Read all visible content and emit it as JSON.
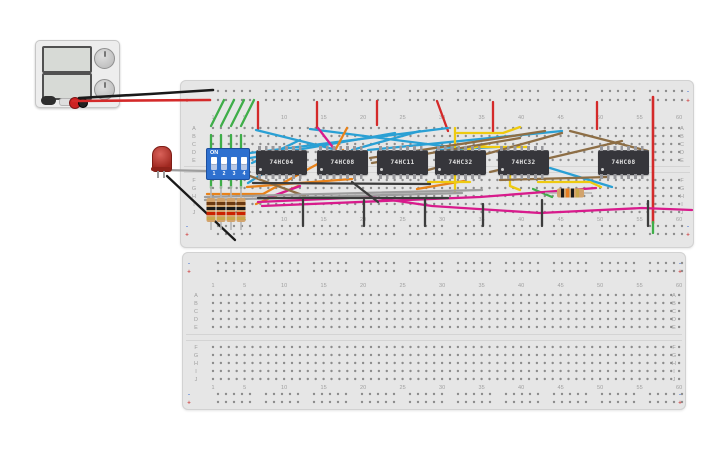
{
  "app": {
    "background": "#ffffff"
  },
  "palette": {
    "cyan": "#2aa0d4",
    "orange": "#e8821a",
    "magenta": "#d81b8c",
    "yellow": "#eeca10",
    "brown": "#8d6e45",
    "gray": "#9e9e9e",
    "ltgray": "#b5b5b5",
    "dark": "#3c3c3c",
    "black": "#1a1a1a",
    "green": "#3fae49",
    "red": "#d42a2a",
    "rail_minus_color": "#5b82d6",
    "rail_plus_color": "#d04a4a",
    "hole_color": "#8c8c8c"
  },
  "breadboards": {
    "col_numbers": [
      "1",
      "5",
      "10",
      "15",
      "20",
      "25",
      "30",
      "35",
      "40",
      "45",
      "50",
      "55",
      "60"
    ],
    "col_positions": [
      1,
      5,
      10,
      15,
      20,
      25,
      30,
      35,
      40,
      45,
      50,
      55,
      60
    ],
    "row_letters_top": [
      "A",
      "B",
      "C",
      "D",
      "E"
    ],
    "row_letters_bottom": [
      "F",
      "G",
      "H",
      "I",
      "J"
    ],
    "rail_minus": "-",
    "rail_plus": "+"
  },
  "circuit": {
    "ics": [
      {
        "label": "74HC04",
        "x": 256
      },
      {
        "label": "74HC08",
        "x": 317
      },
      {
        "label": "74HC11",
        "x": 377
      },
      {
        "label": "74HC32",
        "x": 435
      },
      {
        "label": "74HC32",
        "x": 498
      },
      {
        "label": "74HC08",
        "x": 598
      }
    ],
    "dip_switch": {
      "label": "ON",
      "numbers": [
        "1",
        "2",
        "3",
        "4"
      ]
    },
    "led": {
      "color": "red"
    },
    "resistors_vertical": [
      {
        "x": 211
      },
      {
        "x": 221
      },
      {
        "x": 231
      },
      {
        "x": 241
      }
    ],
    "resistor_horizontal": {
      "x1": 545,
      "x2": 592,
      "y": 193
    },
    "wires": [
      {
        "color": "black",
        "w": 2.6,
        "pts": [
          [
            79,
            98
          ],
          [
            150,
            94
          ],
          [
            213,
            90
          ]
        ]
      },
      {
        "color": "red",
        "w": 2.6,
        "pts": [
          [
            73,
            101
          ],
          [
            210,
            100
          ]
        ]
      },
      {
        "color": "red",
        "pts": [
          [
            258,
            102
          ],
          [
            258,
            129
          ]
        ]
      },
      {
        "color": "red",
        "pts": [
          [
            317,
            102
          ],
          [
            317,
            129
          ]
        ]
      },
      {
        "color": "red",
        "pts": [
          [
            377,
            101
          ],
          [
            377,
            125
          ]
        ]
      },
      {
        "color": "red",
        "pts": [
          [
            437,
            101
          ],
          [
            448,
            131
          ]
        ]
      },
      {
        "color": "red",
        "pts": [
          [
            493,
            102
          ],
          [
            493,
            132
          ]
        ]
      },
      {
        "color": "red",
        "pts": [
          [
            597,
            102
          ],
          [
            597,
            129
          ]
        ]
      },
      {
        "color": "red",
        "w": 2.6,
        "pts": [
          [
            653,
            97
          ],
          [
            653,
            223
          ]
        ]
      },
      {
        "color": "green",
        "pts": [
          [
            653,
            222
          ],
          [
            653,
            233
          ]
        ]
      },
      {
        "color": "green",
        "pts": [
          [
            224,
            100
          ],
          [
            211,
            126
          ]
        ]
      },
      {
        "color": "green",
        "pts": [
          [
            234,
            100
          ],
          [
            221,
            126
          ]
        ]
      },
      {
        "color": "green",
        "pts": [
          [
            244,
            100
          ],
          [
            231,
            126
          ]
        ]
      },
      {
        "color": "green",
        "pts": [
          [
            254,
            100
          ],
          [
            241,
            126
          ]
        ]
      },
      {
        "color": "green",
        "pts": [
          [
            211,
            135
          ],
          [
            211,
            150
          ]
        ]
      },
      {
        "color": "green",
        "pts": [
          [
            221,
            135
          ],
          [
            221,
            150
          ]
        ]
      },
      {
        "color": "green",
        "pts": [
          [
            231,
            135
          ],
          [
            231,
            150
          ]
        ]
      },
      {
        "color": "green",
        "pts": [
          [
            241,
            135
          ],
          [
            241,
            150
          ]
        ]
      },
      {
        "color": "green",
        "pts": [
          [
            211,
            177
          ],
          [
            211,
            188
          ]
        ]
      },
      {
        "color": "green",
        "pts": [
          [
            221,
            177
          ],
          [
            221,
            188
          ]
        ]
      },
      {
        "color": "green",
        "pts": [
          [
            231,
            177
          ],
          [
            231,
            188
          ]
        ]
      },
      {
        "color": "green",
        "pts": [
          [
            241,
            177
          ],
          [
            241,
            188
          ]
        ]
      },
      {
        "color": "green",
        "pts": [
          [
            533,
            189
          ],
          [
            552,
            197
          ]
        ]
      },
      {
        "color": "cyan",
        "pts": [
          [
            250,
            153
          ],
          [
            448,
            128
          ]
        ]
      },
      {
        "color": "cyan",
        "pts": [
          [
            250,
            158
          ],
          [
            395,
            133
          ]
        ]
      },
      {
        "color": "cyan",
        "pts": [
          [
            248,
            183
          ],
          [
            300,
            150
          ]
        ]
      },
      {
        "color": "cyan",
        "pts": [
          [
            252,
            163
          ],
          [
            300,
            140
          ]
        ]
      },
      {
        "color": "cyan",
        "pts": [
          [
            333,
            149
          ],
          [
            256,
            130
          ]
        ]
      },
      {
        "color": "cyan",
        "pts": [
          [
            368,
            150
          ],
          [
            562,
            131
          ]
        ]
      },
      {
        "color": "cyan",
        "pts": [
          [
            310,
            129
          ],
          [
            458,
            148
          ]
        ]
      },
      {
        "color": "cyan",
        "pts": [
          [
            437,
            150
          ],
          [
            497,
            147
          ]
        ]
      },
      {
        "color": "cyan",
        "pts": [
          [
            550,
            168
          ],
          [
            612,
            187
          ]
        ]
      },
      {
        "color": "cyan",
        "pts": [
          [
            352,
            150
          ],
          [
            420,
            131
          ]
        ]
      },
      {
        "color": "orange",
        "pts": [
          [
            207,
            194
          ],
          [
            263,
            194
          ]
        ]
      },
      {
        "color": "orange",
        "pts": [
          [
            263,
            194
          ],
          [
            343,
            150
          ]
        ]
      },
      {
        "color": "orange",
        "pts": [
          [
            247,
            187
          ],
          [
            352,
            179
          ]
        ]
      },
      {
        "color": "orange",
        "pts": [
          [
            330,
            160
          ],
          [
            347,
            128
          ]
        ]
      },
      {
        "color": "orange",
        "pts": [
          [
            417,
            189
          ],
          [
            464,
            181
          ]
        ]
      },
      {
        "color": "orange",
        "pts": [
          [
            256,
            204
          ],
          [
            298,
            186
          ]
        ]
      },
      {
        "color": "magenta",
        "pts": [
          [
            258,
            202
          ],
          [
            370,
            197
          ],
          [
            432,
            206
          ],
          [
            540,
            213
          ],
          [
            642,
            208
          ],
          [
            692,
            210
          ]
        ]
      },
      {
        "color": "magenta",
        "pts": [
          [
            262,
            206
          ],
          [
            480,
            197
          ],
          [
            596,
            188
          ]
        ]
      },
      {
        "color": "magenta",
        "pts": [
          [
            300,
            186
          ],
          [
            265,
            199
          ]
        ]
      },
      {
        "color": "magenta",
        "pts": [
          [
            335,
            150
          ],
          [
            318,
            128
          ]
        ]
      },
      {
        "color": "yellow",
        "pts": [
          [
            455,
            128
          ],
          [
            455,
            193
          ]
        ]
      },
      {
        "color": "yellow",
        "pts": [
          [
            457,
            133
          ],
          [
            503,
            133
          ],
          [
            520,
            127
          ]
        ]
      },
      {
        "color": "yellow",
        "pts": [
          [
            480,
            147
          ],
          [
            527,
            147
          ]
        ]
      },
      {
        "color": "yellow",
        "pts": [
          [
            510,
            152
          ],
          [
            510,
            186
          ],
          [
            520,
            190
          ]
        ]
      },
      {
        "color": "yellow",
        "pts": [
          [
            538,
            182
          ],
          [
            590,
            182
          ],
          [
            601,
            187
          ]
        ]
      },
      {
        "color": "yellow",
        "pts": [
          [
            428,
            182
          ],
          [
            470,
            182
          ]
        ]
      },
      {
        "color": "yellow",
        "pts": [
          [
            437,
            158
          ],
          [
            487,
            144
          ]
        ]
      },
      {
        "color": "brown",
        "pts": [
          [
            370,
            158
          ],
          [
            545,
            131
          ]
        ]
      },
      {
        "color": "brown",
        "pts": [
          [
            372,
            163
          ],
          [
            520,
            138
          ]
        ]
      },
      {
        "color": "brown",
        "pts": [
          [
            428,
            170
          ],
          [
            562,
            133
          ]
        ]
      },
      {
        "color": "brown",
        "pts": [
          [
            490,
            172
          ],
          [
            622,
            141
          ]
        ]
      },
      {
        "color": "brown",
        "pts": [
          [
            500,
            180
          ],
          [
            608,
            177
          ]
        ]
      },
      {
        "color": "brown",
        "pts": [
          [
            250,
            176
          ],
          [
            305,
            196
          ]
        ]
      },
      {
        "color": "brown",
        "pts": [
          [
            570,
            131
          ],
          [
            648,
            151
          ]
        ]
      },
      {
        "color": "gray",
        "pts": [
          [
            205,
            197
          ],
          [
            482,
            190
          ]
        ]
      },
      {
        "color": "gray",
        "pts": [
          [
            205,
            200
          ],
          [
            462,
            193
          ]
        ]
      },
      {
        "color": "gray",
        "pts": [
          [
            164,
            170
          ],
          [
            250,
            172
          ]
        ]
      },
      {
        "color": "dark",
        "pts": [
          [
            253,
            183
          ],
          [
            430,
            184
          ]
        ]
      },
      {
        "color": "dark",
        "pts": [
          [
            258,
            198
          ],
          [
            448,
            198
          ]
        ]
      },
      {
        "color": "dark",
        "pts": [
          [
            303,
            200
          ],
          [
            303,
            226
          ]
        ]
      },
      {
        "color": "dark",
        "pts": [
          [
            364,
            200
          ],
          [
            364,
            226
          ]
        ]
      },
      {
        "color": "dark",
        "pts": [
          [
            425,
            200
          ],
          [
            425,
            226
          ]
        ]
      },
      {
        "color": "dark",
        "pts": [
          [
            483,
            204
          ],
          [
            483,
            226
          ]
        ]
      },
      {
        "color": "dark",
        "pts": [
          [
            542,
            200
          ],
          [
            542,
            226
          ]
        ]
      },
      {
        "color": "dark",
        "pts": [
          [
            648,
            201
          ],
          [
            648,
            226
          ]
        ]
      },
      {
        "color": "dark",
        "pts": [
          [
            352,
            182
          ],
          [
            378,
            202
          ]
        ]
      },
      {
        "color": "black",
        "pts": [
          [
            167,
            176
          ],
          [
            235,
            240
          ]
        ]
      }
    ]
  }
}
